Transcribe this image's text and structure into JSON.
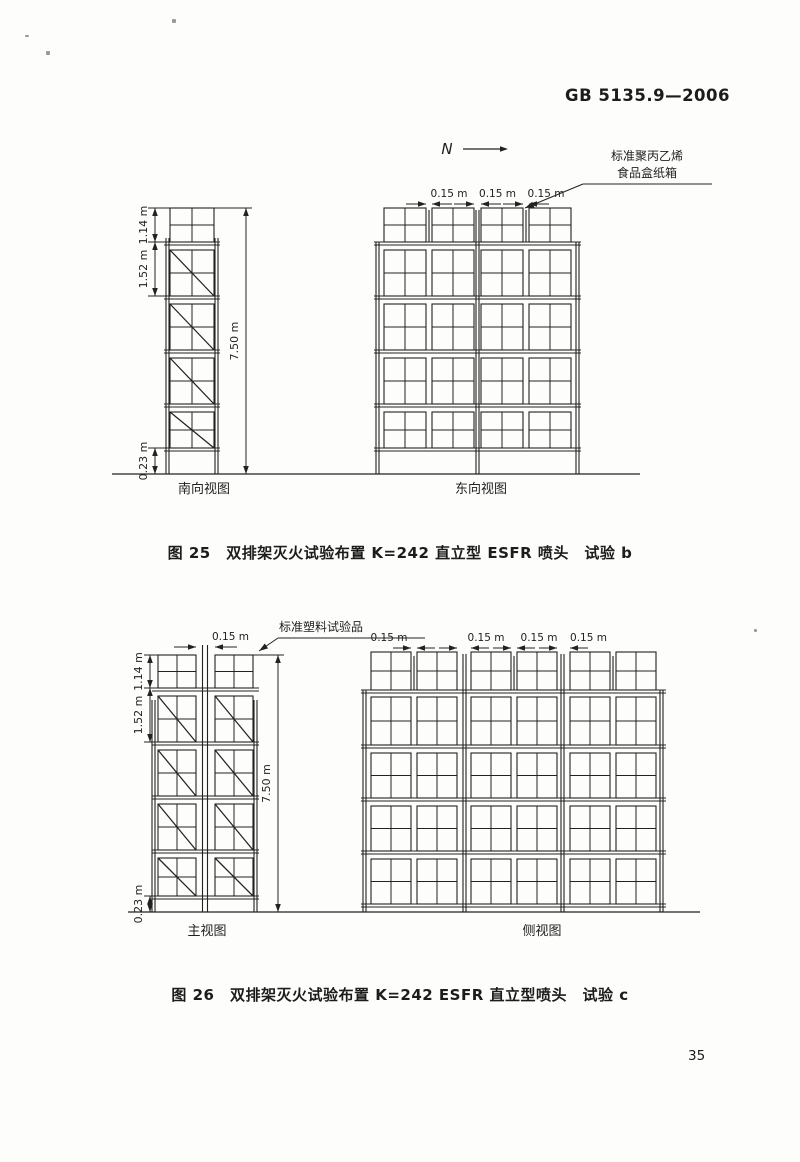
{
  "page": {
    "header": "GB 5135.9—2006",
    "page_number": "35"
  },
  "figure25": {
    "north_label": "N",
    "annotation": {
      "line1": "标准聚丙乙烯",
      "line2": "食品盒纸箱"
    },
    "south_view": {
      "label": "南向视图",
      "columns": 1,
      "tiers": 5,
      "dim_top_tier": "1.14 m",
      "dim_tier": "1.52 m",
      "dim_bottom": "0.23 m",
      "dim_total": "7.50 m"
    },
    "east_view": {
      "label": "东向视图",
      "columns": 4,
      "tiers": 5,
      "gap_dims": [
        "0.15 m",
        "0.15 m",
        "0.15 m"
      ]
    },
    "caption": "图 25　双排架灭火试验布置 K=242 直立型 ESFR 喷头　试验 b"
  },
  "figure26": {
    "annotation": "标准塑料试验品",
    "front_view": {
      "label": "主视图",
      "columns": 2,
      "tiers": 5,
      "dim_gap": "0.15 m",
      "dim_top_tier": "1.14 m",
      "dim_tier": "1.52 m",
      "dim_bottom": "0.23 m",
      "dim_total": "7.50 m"
    },
    "side_view": {
      "label": "侧视图",
      "columns": 6,
      "tiers": 5,
      "gap_dims": [
        "0.15 m",
        "0.15 m",
        "0.15 m",
        "0.15 m"
      ]
    },
    "caption": "图 26　双排架灭火试验布置 K=242 ESFR 直立型喷头　试验 c"
  }
}
